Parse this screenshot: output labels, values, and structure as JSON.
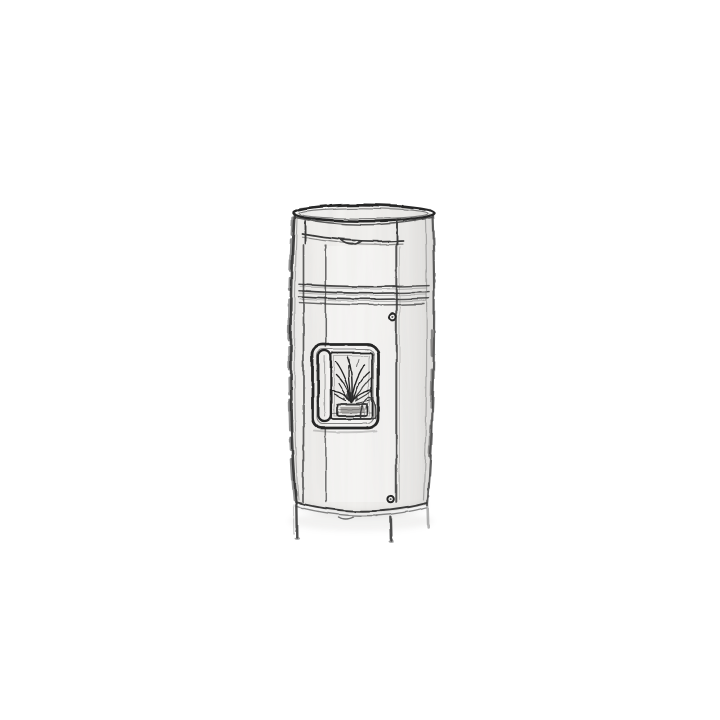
{
  "image": {
    "alt": "Grayscale pencil-style sketch of a tall cylindrical pellet stove on a white background: rounded top lid, upper trim band, three horizontal groove rings, a front door with two small screws, a rounded fire-viewing window with a vertical handle showing burning flames above a small burn pot, and a curved base standing on thin legs.",
    "style": "hand-drawn grayscale sketch",
    "subject": "cylindrical pellet stove with fire window"
  },
  "colors": {
    "background": "#ffffff",
    "ink": "#3a3a3a",
    "ink-dark": "#262626",
    "body": "#f4f3f1",
    "body-light": "#f7f6f4",
    "glass": "#ebeae8",
    "metal": "#e6e5e3",
    "flame-ink": "#242424",
    "shadow": "#8a8782"
  },
  "stove": {
    "parts": {
      "top_lid": "rounded top lid",
      "upper_band": "upper trim band with center tab",
      "groove_rings": "three horizontal groove rings",
      "door": "front door panel",
      "door_screws": "two small door screws",
      "fire_window": "rounded fire-viewing window",
      "window_handle": "vertical window handle",
      "flames": "burning flames",
      "burn_pot": "pellet burn pot",
      "base_rim": "curved base rim",
      "legs": "thin support legs"
    }
  }
}
